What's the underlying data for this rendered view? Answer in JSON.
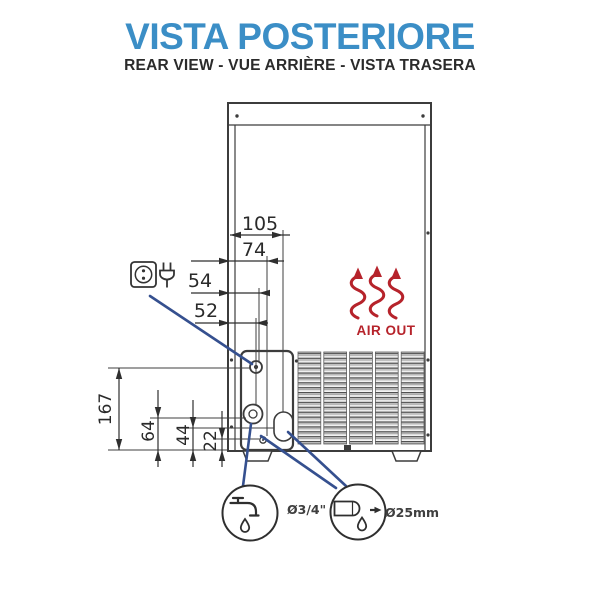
{
  "header": {
    "title": "VISTA POSTERIORE",
    "subtitle": "REAR VIEW - VUE ARRIÈRE - VISTA TRASERA"
  },
  "dimensions": {
    "horizontal": [
      {
        "id": "dim-105",
        "label": "105"
      },
      {
        "id": "dim-74",
        "label": "74"
      },
      {
        "id": "dim-54",
        "label": "54"
      },
      {
        "id": "dim-52",
        "label": "52"
      }
    ],
    "vertical": [
      {
        "id": "dim-167",
        "label": "167"
      },
      {
        "id": "dim-64",
        "label": "64"
      },
      {
        "id": "dim-44",
        "label": "44"
      },
      {
        "id": "dim-22",
        "label": "22"
      }
    ]
  },
  "annotations": {
    "air_out": "AIR OUT",
    "water_inlet_label": "Ø3/4\"",
    "drain_label": "Ø25mm"
  },
  "icons": {
    "power_socket": "power-socket-icon",
    "power_plug": "power-plug-icon",
    "water_tap": "water-tap-icon",
    "drain_pipe": "drain-pipe-icon",
    "air_out_arrows": "air-out-arrows-icon"
  },
  "colors": {
    "title_blue": "#3b8ec6",
    "text_dark": "#2b2b2b",
    "line_dark": "#3c3c3c",
    "accent_red": "#b6232b",
    "callout_blue": "#35508f"
  }
}
